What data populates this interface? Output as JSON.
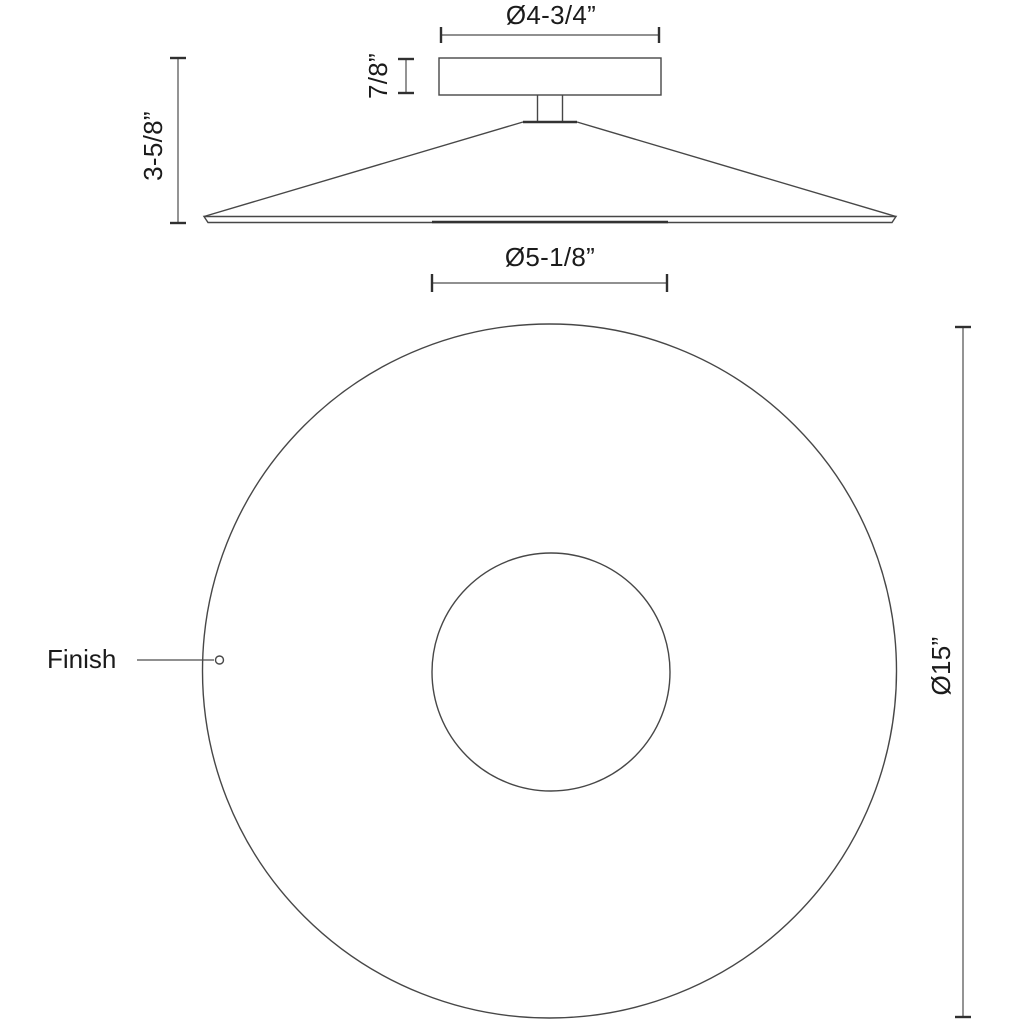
{
  "drawing": {
    "side_view": {
      "dimensions": {
        "canopy_diameter": "Ø4-3/4”",
        "canopy_height": "7/8”",
        "fixture_height": "3-5/8”"
      }
    },
    "plan_view": {
      "dimensions": {
        "inner_diameter": "Ø5-1/8”",
        "outer_diameter": "Ø15”"
      },
      "finish_label": "Finish"
    },
    "colors": {
      "line": "#474747",
      "tick": "#303030",
      "text": "#1b1b1b",
      "background": "#ffffff"
    }
  }
}
